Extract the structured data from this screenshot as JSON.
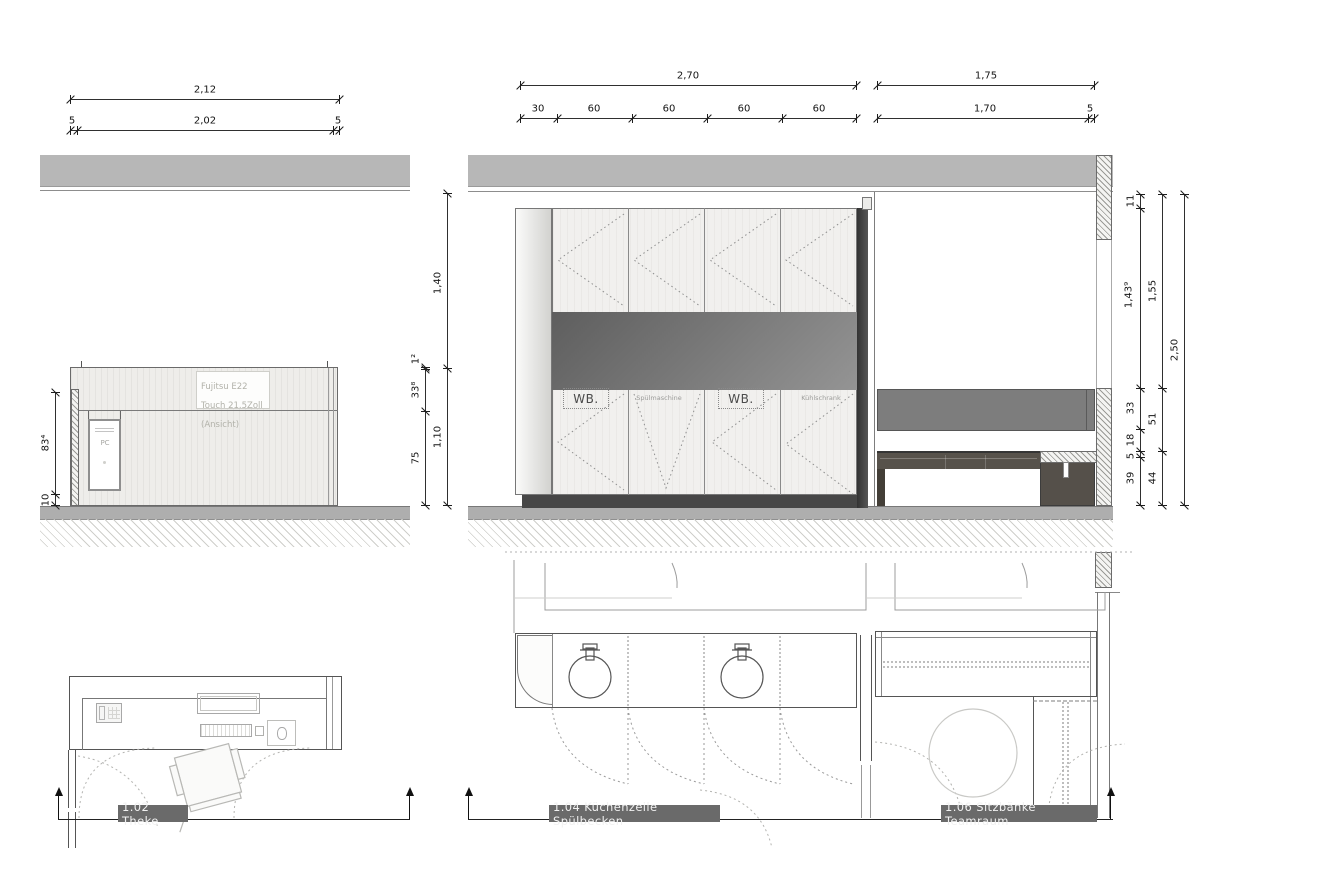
{
  "drawing": {
    "type": "furniture elevations and plans",
    "colors": {
      "ceiling_band": "#b7b7b7",
      "floor_band": "#aeaeae",
      "niche_dark": "#666666",
      "plinth": "#474747",
      "wall_cabinet": "#7d7d7d",
      "bench": "#57524b",
      "section_label_bg": "#6a6a6a",
      "dim_text": "#141414",
      "faint_note": "#b2b2aa"
    }
  },
  "dimensions": {
    "theke_top": {
      "total": "2,12",
      "left_pad": "5",
      "inner": "2,02",
      "right_pad": "5"
    },
    "kueche_top": {
      "total": "2,70",
      "segments": [
        "30",
        "60",
        "60",
        "60",
        "60"
      ]
    },
    "sitzbank_top": {
      "total": "1,75",
      "inner": "1,70",
      "pad": "5"
    },
    "theke_left": {
      "front": "83⁴",
      "base": "10"
    },
    "mid_chain_inner": {
      "top": "1²",
      "counter_top": "33⁸",
      "body": "75"
    },
    "mid_chain_outer": {
      "above": "1,40",
      "counter": "1,10"
    },
    "right_chain_1": {
      "soffit": "11",
      "wall": "1,43⁹",
      "cabinet": "33",
      "gap": "18",
      "seat": "5",
      "legs": "39"
    },
    "right_chain_2": {
      "upper": "1,55",
      "mid": "51",
      "lower": "44"
    },
    "right_chain_3": {
      "total": "2,50"
    }
  },
  "annotations": {
    "monitor_note": "Fujitsu E22\nTouch 21.5Zoll\n(Ansicht)",
    "pc": "PC",
    "washbasin_1": "WB.",
    "dishwasher": "Spülmaschine",
    "washbasin_2": "WB.",
    "fridge": "Kühlschrank"
  },
  "sections": {
    "theke": "1.02 Theke",
    "kueche": "1.04 Küchenzeile Spülbecken",
    "sitzbank": "1.06 Sitzbänke Teamraum"
  }
}
